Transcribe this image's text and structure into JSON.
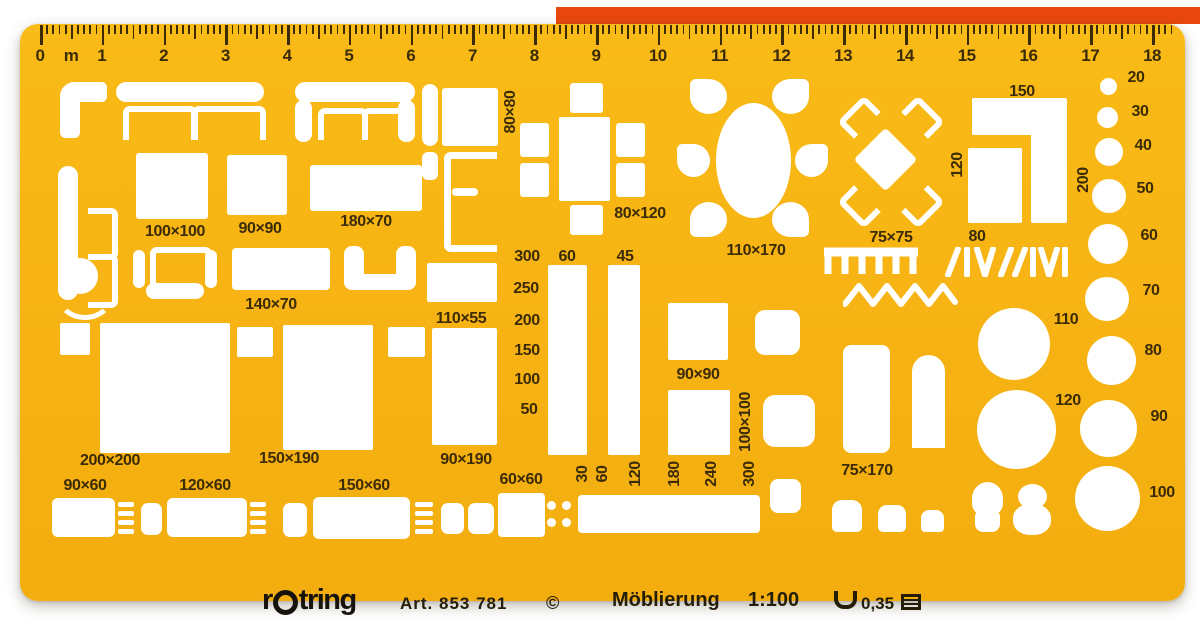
{
  "product": {
    "brand_prefix": "r",
    "brand_suffix": "tring",
    "article": "Art. 853 781",
    "copyright": "©",
    "title": "Möblierung",
    "scale": "1:100",
    "pen_width": "0,35"
  },
  "colors": {
    "template_body": "#F7B414",
    "markings_ink": "#3B2B06",
    "imprint_ink": "#241D08",
    "cutout": "#FFFFFF",
    "red_edge_strip": "#E8470D"
  },
  "ruler": {
    "unit_label": "m",
    "numbers": [
      "0",
      "1",
      "2",
      "3",
      "4",
      "5",
      "6",
      "7",
      "8",
      "9",
      "10",
      "11",
      "12",
      "13",
      "14",
      "15",
      "16",
      "17",
      "18"
    ],
    "origin_x": 40,
    "px_per_unit": 61.78,
    "minor_per_unit": 10,
    "end_tick_index": 183
  },
  "dimension_labels": [
    {
      "text": "100×100",
      "x": 175,
      "y": 232
    },
    {
      "text": "90×90",
      "x": 260,
      "y": 229
    },
    {
      "text": "180×70",
      "x": 366,
      "y": 222
    },
    {
      "text": "140×70",
      "x": 271,
      "y": 305
    },
    {
      "text": "110×55",
      "x": 461,
      "y": 319
    },
    {
      "text": "80×80",
      "x": 511,
      "y": 112,
      "rot": true
    },
    {
      "text": "80×120",
      "x": 640,
      "y": 214
    },
    {
      "text": "110×170",
      "x": 756,
      "y": 251
    },
    {
      "text": "75×75",
      "x": 891,
      "y": 238
    },
    {
      "text": "150",
      "x": 1022,
      "y": 92
    },
    {
      "text": "120",
      "x": 958,
      "y": 165,
      "rot": true
    },
    {
      "text": "200",
      "x": 1084,
      "y": 180,
      "rot": true
    },
    {
      "text": "80",
      "x": 977,
      "y": 237
    },
    {
      "text": "300",
      "x": 527,
      "y": 257
    },
    {
      "text": "250",
      "x": 526,
      "y": 289
    },
    {
      "text": "200",
      "x": 527,
      "y": 321
    },
    {
      "text": "150",
      "x": 527,
      "y": 351
    },
    {
      "text": "100",
      "x": 527,
      "y": 380
    },
    {
      "text": "50",
      "x": 529,
      "y": 410
    },
    {
      "text": "60",
      "x": 567,
      "y": 257
    },
    {
      "text": "45",
      "x": 625,
      "y": 257
    },
    {
      "text": "90×190",
      "x": 466,
      "y": 460
    },
    {
      "text": "200×200",
      "x": 110,
      "y": 461
    },
    {
      "text": "150×190",
      "x": 289,
      "y": 459
    },
    {
      "text": "90×60",
      "x": 85,
      "y": 486
    },
    {
      "text": "120×60",
      "x": 205,
      "y": 486
    },
    {
      "text": "150×60",
      "x": 364,
      "y": 486
    },
    {
      "text": "60×60",
      "x": 521,
      "y": 480
    },
    {
      "text": "90×90",
      "x": 698,
      "y": 375
    },
    {
      "text": "100×100",
      "x": 746,
      "y": 422,
      "rot": true
    },
    {
      "text": "75×170",
      "x": 867,
      "y": 471
    },
    {
      "text": "30",
      "x": 583,
      "y": 474,
      "rot": true
    },
    {
      "text": "60",
      "x": 603,
      "y": 474,
      "rot": true
    },
    {
      "text": "120",
      "x": 636,
      "y": 474,
      "rot": true
    },
    {
      "text": "180",
      "x": 675,
      "y": 474,
      "rot": true
    },
    {
      "text": "240",
      "x": 712,
      "y": 474,
      "rot": true
    },
    {
      "text": "300",
      "x": 750,
      "y": 474,
      "rot": true
    },
    {
      "text": "20",
      "x": 1136,
      "y": 78
    },
    {
      "text": "30",
      "x": 1140,
      "y": 112
    },
    {
      "text": "40",
      "x": 1143,
      "y": 146
    },
    {
      "text": "50",
      "x": 1145,
      "y": 189
    },
    {
      "text": "60",
      "x": 1149,
      "y": 236
    },
    {
      "text": "70",
      "x": 1151,
      "y": 291
    },
    {
      "text": "80",
      "x": 1153,
      "y": 351
    },
    {
      "text": "90",
      "x": 1159,
      "y": 417
    },
    {
      "text": "100",
      "x": 1162,
      "y": 493
    },
    {
      "text": "110",
      "x": 1066,
      "y": 320
    },
    {
      "text": "120",
      "x": 1068,
      "y": 401
    }
  ],
  "cutouts": [
    {
      "n": "corner-sofa-cutout",
      "t": "rect",
      "x": 60,
      "y": 82,
      "w": 47,
      "h": 20,
      "r": "16px 6px 6px 6px"
    },
    {
      "n": "corner-sofa-cutout",
      "t": "rect",
      "x": 60,
      "y": 82,
      "w": 20,
      "h": 56,
      "r": "16px 6px 6px 6px"
    },
    {
      "n": "sofa-back-cutout",
      "t": "rect",
      "x": 116,
      "y": 82,
      "w": 148,
      "h": 20,
      "r": "10px"
    },
    {
      "n": "sofa-cushion-cutout",
      "t": "u-down",
      "x": 123,
      "y": 106,
      "w": 62,
      "h": 28,
      "s": 6
    },
    {
      "n": "sofa-cushion-cutout",
      "t": "u-down",
      "x": 192,
      "y": 106,
      "w": 62,
      "h": 28,
      "s": 6
    },
    {
      "n": "sofa-back-cutout",
      "t": "rect",
      "x": 295,
      "y": 82,
      "w": 120,
      "h": 20,
      "r": "10px"
    },
    {
      "n": "sofa-arm-cutout",
      "t": "rect",
      "x": 295,
      "y": 100,
      "w": 17,
      "h": 42,
      "r": "8px"
    },
    {
      "n": "sofa-arm-cutout",
      "t": "rect",
      "x": 398,
      "y": 100,
      "w": 17,
      "h": 42,
      "r": "8px"
    },
    {
      "n": "sofa-cushion-cutout",
      "t": "u-down",
      "x": 318,
      "y": 108,
      "w": 38,
      "h": 26,
      "s": 6
    },
    {
      "n": "sofa-cushion-cutout",
      "t": "u-down",
      "x": 362,
      "y": 108,
      "w": 38,
      "h": 26,
      "s": 6
    },
    {
      "n": "sofa-back-cutout",
      "t": "rect",
      "x": 58,
      "y": 166,
      "w": 20,
      "h": 134,
      "r": "10px"
    },
    {
      "n": "sofa-cushion-cutout",
      "t": "u-left",
      "x": 88,
      "y": 208,
      "w": 24,
      "h": 40,
      "s": 6
    },
    {
      "n": "sofa-cushion-cutout",
      "t": "u-left",
      "x": 88,
      "y": 254,
      "w": 24,
      "h": 42,
      "s": 6
    },
    {
      "n": "stool-circle-cutout",
      "t": "circle",
      "x": 62,
      "y": 258,
      "w": 36,
      "h": 36
    },
    {
      "n": "stool-arc-cutout",
      "t": "arc-bottom",
      "x": 56,
      "y": 270,
      "w": 48,
      "h": 40,
      "s": 5
    },
    {
      "n": "armchair-seat-cutout",
      "t": "u-down",
      "x": 150,
      "y": 247,
      "w": 50,
      "h": 32,
      "s": 6
    },
    {
      "n": "armchair-back-cutout",
      "t": "rect",
      "x": 146,
      "y": 283,
      "w": 58,
      "h": 16,
      "r": "8px"
    },
    {
      "n": "armchair-arm-cutout",
      "t": "rect",
      "x": 133,
      "y": 250,
      "w": 12,
      "h": 38,
      "r": "6px"
    },
    {
      "n": "armchair-arm-cutout",
      "t": "rect",
      "x": 205,
      "y": 250,
      "w": 12,
      "h": 38,
      "r": "6px"
    },
    {
      "n": "table-140x70-cutout",
      "t": "rect",
      "x": 232,
      "y": 248,
      "w": 98,
      "h": 42,
      "r": "4px"
    },
    {
      "n": "chair-arm-cutout",
      "t": "rect",
      "x": 344,
      "y": 246,
      "w": 20,
      "h": 44,
      "r": "8px"
    },
    {
      "n": "chair-arm-cutout",
      "t": "rect",
      "x": 396,
      "y": 246,
      "w": 20,
      "h": 44,
      "r": "8px"
    },
    {
      "n": "chair-back-cutout",
      "t": "rect",
      "x": 344,
      "y": 274,
      "w": 72,
      "h": 16,
      "r": "8px"
    },
    {
      "n": "square-100x100-cutout",
      "t": "rect",
      "x": 136,
      "y": 153,
      "w": 72,
      "h": 66,
      "r": "3px"
    },
    {
      "n": "square-90x90-cutout",
      "t": "rect",
      "x": 227,
      "y": 155,
      "w": 60,
      "h": 60,
      "r": "3px"
    },
    {
      "n": "rect-180x70-cutout",
      "t": "rect",
      "x": 310,
      "y": 165,
      "w": 112,
      "h": 46,
      "r": "3px"
    },
    {
      "n": "bar-cutout",
      "t": "rect",
      "x": 422,
      "y": 84,
      "w": 16,
      "h": 62,
      "r": "8px"
    },
    {
      "n": "square-80x80-cutout",
      "t": "rect",
      "x": 442,
      "y": 88,
      "w": 56,
      "h": 58,
      "r": "3px"
    },
    {
      "n": "bar-cutout",
      "t": "rect",
      "x": 422,
      "y": 152,
      "w": 16,
      "h": 28,
      "r": "6px"
    },
    {
      "n": "bench-outline-cutout",
      "t": "u-right",
      "x": 444,
      "y": 152,
      "w": 46,
      "h": 86,
      "s": 7
    },
    {
      "n": "bench-inner-cutout",
      "t": "rect",
      "x": 452,
      "y": 188,
      "w": 26,
      "h": 8,
      "r": "4px"
    },
    {
      "n": "chair-cutout",
      "t": "rect",
      "x": 570,
      "y": 83,
      "w": 33,
      "h": 30,
      "r": "3px"
    },
    {
      "n": "table-80x120-cutout",
      "t": "rect",
      "x": 559,
      "y": 117,
      "w": 51,
      "h": 84,
      "r": "2px"
    },
    {
      "n": "chair-cutout",
      "t": "rect",
      "x": 520,
      "y": 123,
      "w": 29,
      "h": 34,
      "r": "3px"
    },
    {
      "n": "chair-cutout",
      "t": "rect",
      "x": 520,
      "y": 163,
      "w": 29,
      "h": 34,
      "r": "3px"
    },
    {
      "n": "chair-cutout",
      "t": "rect",
      "x": 616,
      "y": 123,
      "w": 29,
      "h": 34,
      "r": "3px"
    },
    {
      "n": "chair-cutout",
      "t": "rect",
      "x": 616,
      "y": 163,
      "w": 29,
      "h": 34,
      "r": "3px"
    },
    {
      "n": "chair-cutout",
      "t": "rect",
      "x": 570,
      "y": 205,
      "w": 33,
      "h": 30,
      "r": "3px"
    },
    {
      "n": "oval-table-cutout",
      "t": "ellipse",
      "x": 716,
      "y": 103,
      "w": 75,
      "h": 115
    },
    {
      "n": "chair-petal-cutout",
      "t": "petal",
      "x": 690,
      "y": 79,
      "w": 37,
      "h": 35,
      "tip": "tl"
    },
    {
      "n": "chair-petal-cutout",
      "t": "petal",
      "x": 772,
      "y": 79,
      "w": 37,
      "h": 35,
      "tip": "tr"
    },
    {
      "n": "chair-petal-cutout",
      "t": "petal",
      "x": 677,
      "y": 144,
      "w": 33,
      "h": 33,
      "tip": "tl"
    },
    {
      "n": "chair-petal-cutout",
      "t": "petal",
      "x": 795,
      "y": 144,
      "w": 33,
      "h": 33,
      "tip": "tr"
    },
    {
      "n": "chair-petal-cutout",
      "t": "petal",
      "x": 690,
      "y": 202,
      "w": 37,
      "h": 35,
      "tip": "bl"
    },
    {
      "n": "chair-petal-cutout",
      "t": "petal",
      "x": 772,
      "y": 202,
      "w": 37,
      "h": 35,
      "tip": "br"
    },
    {
      "n": "diamond-table-cutout",
      "t": "rect",
      "x": 863,
      "y": 137,
      "w": 45,
      "h": 45,
      "r": "4px",
      "rot": 45
    },
    {
      "n": "chair-diag-cutout",
      "t": "u-down",
      "x": 840,
      "y": 105,
      "w": 26,
      "h": 18,
      "s": 6,
      "rot": -45
    },
    {
      "n": "chair-diag-cutout",
      "t": "u-down",
      "x": 904,
      "y": 105,
      "w": 26,
      "h": 18,
      "s": 6,
      "rot": 45
    },
    {
      "n": "chair-diag-cutout",
      "t": "u-down",
      "x": 840,
      "y": 195,
      "w": 26,
      "h": 18,
      "s": 6,
      "rot": -135
    },
    {
      "n": "chair-diag-cutout",
      "t": "u-down",
      "x": 904,
      "y": 195,
      "w": 26,
      "h": 18,
      "s": 6,
      "rot": 135
    },
    {
      "n": "counter-top-cutout",
      "t": "rect",
      "x": 972,
      "y": 98,
      "w": 95,
      "h": 37,
      "r": "2px"
    },
    {
      "n": "counter-side-cutout",
      "t": "rect",
      "x": 1031,
      "y": 120,
      "w": 36,
      "h": 103,
      "r": "2px"
    },
    {
      "n": "counter-square-cutout",
      "t": "rect",
      "x": 968,
      "y": 148,
      "w": 54,
      "h": 75,
      "r": "2px"
    },
    {
      "n": "circle-20-cutout",
      "t": "circle",
      "x": 1100,
      "y": 78,
      "w": 17,
      "h": 17
    },
    {
      "n": "circle-30-cutout",
      "t": "circle",
      "x": 1097,
      "y": 107,
      "w": 21,
      "h": 21
    },
    {
      "n": "circle-40-cutout",
      "t": "circle",
      "x": 1095,
      "y": 138,
      "w": 28,
      "h": 28
    },
    {
      "n": "circle-50-cutout",
      "t": "circle",
      "x": 1092,
      "y": 179,
      "w": 34,
      "h": 34
    },
    {
      "n": "circle-60-cutout",
      "t": "circle",
      "x": 1088,
      "y": 224,
      "w": 40,
      "h": 40
    },
    {
      "n": "circle-70-cutout",
      "t": "circle",
      "x": 1085,
      "y": 277,
      "w": 44,
      "h": 44
    },
    {
      "n": "circle-80-cutout",
      "t": "circle",
      "x": 1087,
      "y": 336,
      "w": 49,
      "h": 49
    },
    {
      "n": "circle-90-cutout",
      "t": "circle",
      "x": 1080,
      "y": 400,
      "w": 57,
      "h": 57
    },
    {
      "n": "circle-100-cutout",
      "t": "circle",
      "x": 1075,
      "y": 466,
      "w": 65,
      "h": 65
    },
    {
      "n": "circle-110-cutout",
      "t": "circle",
      "x": 978,
      "y": 308,
      "w": 72,
      "h": 72
    },
    {
      "n": "circle-120-cutout",
      "t": "circle",
      "x": 977,
      "y": 390,
      "w": 79,
      "h": 79
    },
    {
      "n": "nightstand-cutout",
      "t": "rect",
      "x": 60,
      "y": 323,
      "w": 30,
      "h": 32,
      "r": "2px"
    },
    {
      "n": "bed-200x200-cutout",
      "t": "rect",
      "x": 100,
      "y": 323,
      "w": 130,
      "h": 130,
      "r": "2px"
    },
    {
      "n": "nightstand-cutout",
      "t": "rect",
      "x": 237,
      "y": 327,
      "w": 36,
      "h": 30,
      "r": "2px"
    },
    {
      "n": "bed-150x190-cutout",
      "t": "rect",
      "x": 283,
      "y": 325,
      "w": 90,
      "h": 125,
      "r": "2px"
    },
    {
      "n": "nightstand-cutout",
      "t": "rect",
      "x": 388,
      "y": 327,
      "w": 37,
      "h": 30,
      "r": "2px"
    },
    {
      "n": "table-110x55-cutout",
      "t": "rect",
      "x": 427,
      "y": 263,
      "w": 70,
      "h": 39,
      "r": "2px"
    },
    {
      "n": "wardrobe-90x190-cutout",
      "t": "rect",
      "x": 432,
      "y": 328,
      "w": 65,
      "h": 117,
      "r": "2px"
    },
    {
      "n": "bar-60-cutout",
      "t": "rect",
      "x": 548,
      "y": 265,
      "w": 39,
      "h": 190,
      "r": "2px"
    },
    {
      "n": "bar-45-cutout",
      "t": "rect",
      "x": 608,
      "y": 265,
      "w": 32,
      "h": 190,
      "r": "2px"
    },
    {
      "n": "square-90x90-cutout",
      "t": "rect",
      "x": 668,
      "y": 303,
      "w": 60,
      "h": 57,
      "r": "2px"
    },
    {
      "n": "rounded-square-cutout",
      "t": "rect",
      "x": 755,
      "y": 310,
      "w": 45,
      "h": 45,
      "r": "10px"
    },
    {
      "n": "square-100x100-cutout",
      "t": "rect",
      "x": 668,
      "y": 390,
      "w": 62,
      "h": 65,
      "r": "2px"
    },
    {
      "n": "rounded-square-cutout",
      "t": "rect",
      "x": 763,
      "y": 395,
      "w": 52,
      "h": 52,
      "r": "12px"
    },
    {
      "n": "bathtub-75x170-cutout",
      "t": "rect",
      "x": 843,
      "y": 345,
      "w": 47,
      "h": 108,
      "r": "8px"
    },
    {
      "n": "door-arch-cutout",
      "t": "rect",
      "x": 912,
      "y": 355,
      "w": 33,
      "h": 93,
      "r": "17px 17px 0 0"
    },
    {
      "n": "desk-90x60-cutout",
      "t": "rect",
      "x": 52,
      "y": 498,
      "w": 63,
      "h": 39,
      "r": "6px"
    },
    {
      "n": "hatch-stripes-cutout",
      "t": "stripes",
      "x": 118,
      "y": 502,
      "w": 16,
      "h": 36
    },
    {
      "n": "chair-square-cutout",
      "t": "rect",
      "x": 141,
      "y": 503,
      "w": 21,
      "h": 32,
      "r": "7px"
    },
    {
      "n": "desk-120x60-cutout",
      "t": "rect",
      "x": 167,
      "y": 498,
      "w": 80,
      "h": 39,
      "r": "6px"
    },
    {
      "n": "hatch-stripes-cutout",
      "t": "stripes",
      "x": 250,
      "y": 502,
      "w": 16,
      "h": 36
    },
    {
      "n": "chair-square-cutout",
      "t": "rect",
      "x": 283,
      "y": 503,
      "w": 24,
      "h": 34,
      "r": "7px"
    },
    {
      "n": "desk-150x60-cutout",
      "t": "rect",
      "x": 313,
      "y": 497,
      "w": 97,
      "h": 42,
      "r": "6px"
    },
    {
      "n": "hatch-stripes-cutout",
      "t": "stripes",
      "x": 415,
      "y": 502,
      "w": 18,
      "h": 36
    },
    {
      "n": "chair-square-cutout",
      "t": "rect",
      "x": 441,
      "y": 503,
      "w": 23,
      "h": 31,
      "r": "7px"
    },
    {
      "n": "chair-square-cutout",
      "t": "rect",
      "x": 468,
      "y": 503,
      "w": 26,
      "h": 31,
      "r": "7px"
    },
    {
      "n": "square-60x60-cutout",
      "t": "rect",
      "x": 498,
      "y": 493,
      "w": 47,
      "h": 44,
      "r": "4px"
    },
    {
      "n": "dot-cutout",
      "t": "circle",
      "x": 547,
      "y": 501,
      "w": 9,
      "h": 9
    },
    {
      "n": "dot-cutout",
      "t": "circle",
      "x": 562,
      "y": 501,
      "w": 9,
      "h": 9
    },
    {
      "n": "dot-cutout",
      "t": "circle",
      "x": 547,
      "y": 518,
      "w": 9,
      "h": 9
    },
    {
      "n": "dot-cutout",
      "t": "circle",
      "x": 562,
      "y": 518,
      "w": 9,
      "h": 9
    },
    {
      "n": "bench-300-cutout",
      "t": "rect",
      "x": 578,
      "y": 495,
      "w": 182,
      "h": 38,
      "r": "4px"
    },
    {
      "n": "cabinet-cutout",
      "t": "rect",
      "x": 770,
      "y": 479,
      "w": 31,
      "h": 34,
      "r": "8px"
    },
    {
      "n": "sink-cutout",
      "t": "rect",
      "x": 832,
      "y": 500,
      "w": 30,
      "h": 32,
      "r": "10px 10px 5px 5px"
    },
    {
      "n": "sink-cutout",
      "t": "rect",
      "x": 878,
      "y": 505,
      "w": 28,
      "h": 27,
      "r": "9px 9px 5px 5px"
    },
    {
      "n": "sink-cutout",
      "t": "rect",
      "x": 921,
      "y": 510,
      "w": 23,
      "h": 22,
      "r": "8px 8px 4px 4px"
    },
    {
      "n": "toilet-bowl-cutout",
      "t": "rect",
      "x": 972,
      "y": 482,
      "w": 31,
      "h": 33,
      "r": "50% 50% 35% 35%"
    },
    {
      "n": "toilet-base-cutout",
      "t": "rect",
      "x": 975,
      "y": 512,
      "w": 25,
      "h": 20,
      "r": "4px 4px 8px 8px"
    },
    {
      "n": "toilet-tank-cutout",
      "t": "rect",
      "x": 1018,
      "y": 484,
      "w": 29,
      "h": 25,
      "r": "50%"
    },
    {
      "n": "toilet-bowl-cutout",
      "t": "rect",
      "x": 1013,
      "y": 504,
      "w": 38,
      "h": 31,
      "r": "45%"
    }
  ]
}
